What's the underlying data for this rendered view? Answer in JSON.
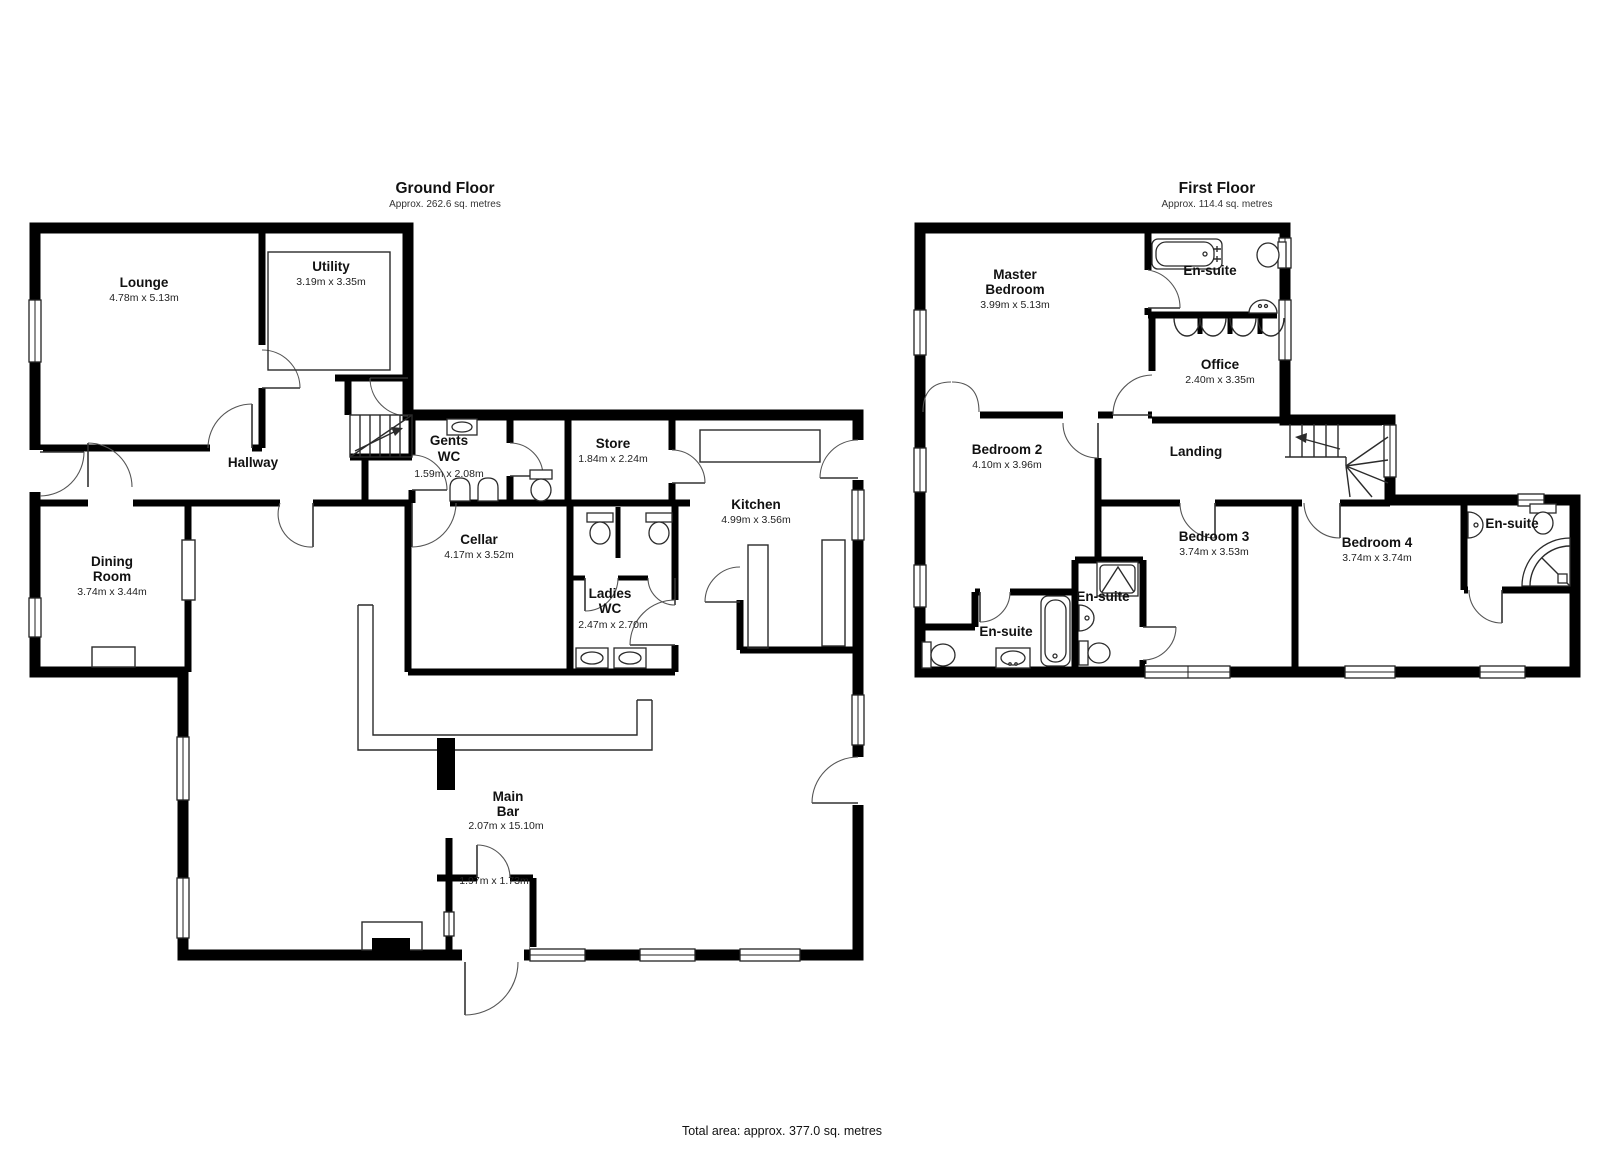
{
  "colors": {
    "wall": "#000000",
    "background": "#ffffff",
    "text": "#111111"
  },
  "footer": {
    "total_area": "Total area: approx. 377.0 sq. metres"
  },
  "ground_floor": {
    "title": "Ground Floor",
    "subtitle": "Approx. 262.6 sq. metres",
    "rooms": {
      "lounge": {
        "name": "Lounge",
        "dims": "4.78m x 5.13m"
      },
      "utility": {
        "name": "Utility",
        "dims": "3.19m x 3.35m"
      },
      "hallway": {
        "name": "Hallway"
      },
      "gents_wc": {
        "line1": "Gents",
        "line2": "WC",
        "dims": "1.59m x 2.08m"
      },
      "store": {
        "name": "Store",
        "dims": "1.84m x 2.24m"
      },
      "kitchen": {
        "name": "Kitchen",
        "dims": "4.99m x 3.56m"
      },
      "cellar": {
        "name": "Cellar",
        "dims": "4.17m x 3.52m"
      },
      "ladies_wc": {
        "line1": "Ladies",
        "line2": "WC",
        "dims": "2.47m x 2.70m"
      },
      "dining_room": {
        "line1": "Dining",
        "line2": "Room",
        "dims": "3.74m x 3.44m"
      },
      "main_bar": {
        "line1": "Main",
        "line2": "Bar",
        "dims": "2.07m x 15.10m"
      },
      "porch": {
        "dims": "1.97m x 1.73m"
      }
    }
  },
  "first_floor": {
    "title": "First Floor",
    "subtitle": "Approx. 114.4 sq. metres",
    "rooms": {
      "master_bedroom": {
        "line1": "Master",
        "line2": "Bedroom",
        "dims": "3.99m x 5.13m"
      },
      "ensuite_master": {
        "name": "En-suite"
      },
      "office": {
        "name": "Office",
        "dims": "2.40m x 3.35m"
      },
      "landing": {
        "name": "Landing"
      },
      "bedroom2": {
        "name": "Bedroom 2",
        "dims": "4.10m x 3.96m"
      },
      "bedroom3": {
        "name": "Bedroom 3",
        "dims": "3.74m x 3.53m"
      },
      "bedroom4": {
        "name": "Bedroom 4",
        "dims": "3.74m x 3.74m"
      },
      "ensuite_bed2": {
        "name": "En-suite"
      },
      "ensuite_bed3": {
        "name": "En-suite"
      },
      "ensuite_bed4": {
        "name": "En-suite"
      }
    }
  }
}
